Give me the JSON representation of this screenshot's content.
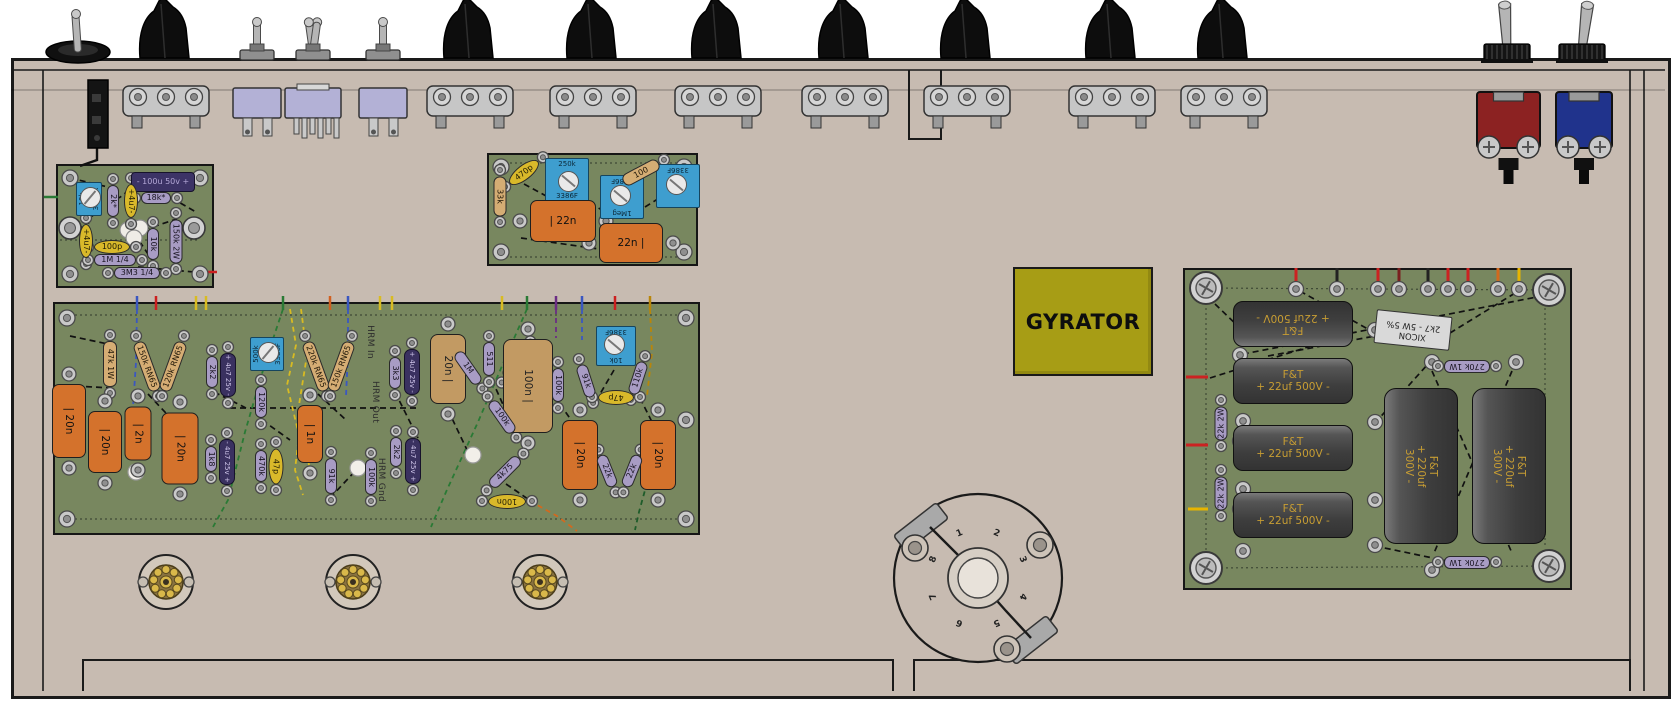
{
  "colors": {
    "chassis": "#c7bbb1",
    "board_green": "#78875f",
    "cap_orange": "#d4722c",
    "cap_tan": "#c29a63",
    "resistor_purple": "#a89cc4",
    "trimmer_blue": "#3e9ecf",
    "gyrator_yellow": "#a79d15",
    "power_cap_gray": "#3e3e3e",
    "power_cap_text": "#c79d33"
  },
  "labels": {
    "gyrator": "GYRATOR"
  },
  "rotary": {
    "pins": [
      "1",
      "2",
      "3",
      "4",
      "5",
      "6",
      "7",
      "8"
    ]
  },
  "tube_sockets": [
    {
      "x": 166,
      "y": 582
    },
    {
      "x": 353,
      "y": 582
    },
    {
      "x": 540,
      "y": 582
    }
  ],
  "top_controls": {
    "power_toggle": {
      "x": 78
    },
    "knobs": [
      {
        "x": 166
      },
      {
        "x": 470
      },
      {
        "x": 593
      },
      {
        "x": 718
      },
      {
        "x": 845
      },
      {
        "x": 967
      },
      {
        "x": 1112
      },
      {
        "x": 1224
      }
    ],
    "small_toggles": [
      {
        "x": 257,
        "double": false
      },
      {
        "x": 313,
        "double": true
      },
      {
        "x": 383,
        "double": false
      }
    ],
    "big_toggles": [
      {
        "x": 1507,
        "tilt": -3
      },
      {
        "x": 1582,
        "tilt": 7
      }
    ],
    "binding_posts": [
      {
        "x": 1477,
        "w": 63,
        "color": "#8c2222"
      },
      {
        "x": 1556,
        "w": 56,
        "color": "#20338c"
      }
    ]
  },
  "boards": [
    {
      "id": "small-preamp-board",
      "x": 56,
      "y": 164,
      "w": 158,
      "h": 124,
      "components": [
        {
          "t": "box",
          "x": 163,
          "y": 182,
          "w": 64,
          "h": 20,
          "r": 0,
          "v": "- 100u 50v +"
        },
        {
          "t": "bt",
          "x": 89,
          "y": 199,
          "w": 34,
          "h": 26,
          "r": -90,
          "v": "10k/3296X"
        },
        {
          "t": "pr",
          "x": 113,
          "y": 201,
          "w": 32,
          "h": 12,
          "r": 90,
          "v": "2k*"
        },
        {
          "t": "yc",
          "x": 131,
          "y": 201,
          "w": 34,
          "h": 14,
          "r": 90,
          "v": "+4u7-"
        },
        {
          "t": "pr",
          "x": 156,
          "y": 198,
          "w": 30,
          "h": 12,
          "r": 0,
          "v": "18k*"
        },
        {
          "t": "yc",
          "x": 86,
          "y": 241,
          "w": 34,
          "h": 14,
          "r": 90,
          "v": "+4u7-"
        },
        {
          "t": "pr",
          "x": 153,
          "y": 244,
          "w": 32,
          "h": 12,
          "r": 90,
          "v": "10k"
        },
        {
          "t": "pr",
          "x": 176,
          "y": 241,
          "w": 44,
          "h": 13,
          "r": 90,
          "v": "150k 2W"
        },
        {
          "t": "yc",
          "x": 112,
          "y": 247,
          "w": 36,
          "h": 14,
          "r": 0,
          "v": "100p"
        },
        {
          "t": "pr",
          "x": 115,
          "y": 260,
          "w": 42,
          "h": 12,
          "r": 0,
          "v": "1M 1/4"
        },
        {
          "t": "pr",
          "x": 137,
          "y": 273,
          "w": 46,
          "h": 12,
          "r": 0,
          "v": "3M3 1/4"
        }
      ]
    },
    {
      "id": "trimmer-board",
      "x": 487,
      "y": 153,
      "w": 211,
      "h": 113,
      "components": [
        {
          "t": "tr",
          "x": 500,
          "y": 196,
          "w": 40,
          "h": 13,
          "r": 90,
          "v": "33k"
        },
        {
          "t": "yc",
          "x": 524,
          "y": 172,
          "w": 36,
          "h": 15,
          "r": -38,
          "v": "470p"
        },
        {
          "t": "bt",
          "x": 567,
          "y": 180,
          "w": 44,
          "h": 44,
          "r": 0,
          "v": "250k/3386F"
        },
        {
          "t": "bt",
          "x": 622,
          "y": 197,
          "w": 44,
          "h": 44,
          "r": 180,
          "v": "1Meg/3386F"
        },
        {
          "t": "bt",
          "x": 678,
          "y": 186,
          "w": 44,
          "h": 44,
          "r": 180,
          "v": "/3386F"
        },
        {
          "t": "tr",
          "x": 641,
          "y": 172,
          "w": 40,
          "h": 13,
          "r": -28,
          "v": "100"
        },
        {
          "t": "or",
          "x": 563,
          "y": 221,
          "w": 66,
          "h": 42,
          "r": 0,
          "v": "| 22n"
        },
        {
          "t": "or",
          "x": 631,
          "y": 243,
          "w": 64,
          "h": 40,
          "r": 0,
          "v": "22n |"
        }
      ]
    },
    {
      "id": "main-board",
      "x": 53,
      "y": 302,
      "w": 647,
      "h": 233,
      "components": [
        {
          "t": "tr",
          "x": 110,
          "y": 364,
          "w": 46,
          "h": 14,
          "r": 90,
          "v": "47k 1W"
        },
        {
          "t": "tr",
          "x": 147,
          "y": 366,
          "w": 52,
          "h": 13,
          "r": 70,
          "v": "150k RN65"
        },
        {
          "t": "tr",
          "x": 173,
          "y": 366,
          "w": 52,
          "h": 13,
          "r": -70,
          "v": "120k RN65"
        },
        {
          "t": "or",
          "x": 69,
          "y": 421,
          "w": 74,
          "h": 34,
          "r": 90,
          "v": "| 20n"
        },
        {
          "t": "or",
          "x": 105,
          "y": 442,
          "w": 62,
          "h": 34,
          "r": 90,
          "v": "| 20n"
        },
        {
          "t": "or",
          "x": 138,
          "y": 433,
          "w": 54,
          "h": 27,
          "r": 90,
          "v": "| 2n"
        },
        {
          "t": "or",
          "x": 180,
          "y": 448,
          "w": 72,
          "h": 37,
          "r": 90,
          "v": "| 20n"
        },
        {
          "t": "pr",
          "x": 212,
          "y": 372,
          "w": 32,
          "h": 12,
          "r": 90,
          "v": "2k2"
        },
        {
          "t": "dk",
          "x": 228,
          "y": 375,
          "w": 44,
          "h": 16,
          "r": 90,
          "v": "+ 4u7 25v -"
        },
        {
          "t": "bt",
          "x": 267,
          "y": 354,
          "w": 34,
          "h": 34,
          "r": -90,
          "v": "500k/3386F"
        },
        {
          "t": "pr",
          "x": 261,
          "y": 402,
          "w": 32,
          "h": 12,
          "r": 90,
          "v": "120k"
        },
        {
          "t": "pr",
          "x": 211,
          "y": 459,
          "w": 26,
          "h": 12,
          "r": 90,
          "v": "1k8"
        },
        {
          "t": "dk",
          "x": 227,
          "y": 462,
          "w": 46,
          "h": 16,
          "r": 90,
          "v": "- 4u7 25v +"
        },
        {
          "t": "pr",
          "x": 261,
          "y": 466,
          "w": 32,
          "h": 12,
          "r": 90,
          "v": "470k"
        },
        {
          "t": "yc",
          "x": 276,
          "y": 466,
          "w": 36,
          "h": 15,
          "r": 90,
          "v": "47p"
        },
        {
          "t": "tr",
          "x": 316,
          "y": 366,
          "w": 52,
          "h": 13,
          "r": 70,
          "v": "220k RN65"
        },
        {
          "t": "tr",
          "x": 341,
          "y": 366,
          "w": 52,
          "h": 13,
          "r": -70,
          "v": "150k RN65"
        },
        {
          "t": "or",
          "x": 310,
          "y": 434,
          "w": 58,
          "h": 26,
          "r": 90,
          "v": "| 1n"
        },
        {
          "t": "pr",
          "x": 331,
          "y": 476,
          "w": 36,
          "h": 12,
          "r": 90,
          "v": "91k"
        },
        {
          "t": "pr",
          "x": 371,
          "y": 477,
          "w": 36,
          "h": 12,
          "r": 90,
          "v": "100k"
        },
        {
          "t": "tx",
          "x": 370,
          "y": 342,
          "w": 46,
          "h": 10,
          "r": 90,
          "v": "HRM In"
        },
        {
          "t": "tx",
          "x": 375,
          "y": 402,
          "w": 50,
          "h": 10,
          "r": 90,
          "v": "HRM Out"
        },
        {
          "t": "tx",
          "x": 381,
          "y": 480,
          "w": 52,
          "h": 10,
          "r": 90,
          "v": "HRM Gnd"
        },
        {
          "t": "pr",
          "x": 395,
          "y": 373,
          "w": 32,
          "h": 12,
          "r": 90,
          "v": "3k3"
        },
        {
          "t": "dk",
          "x": 412,
          "y": 372,
          "w": 46,
          "h": 16,
          "r": 90,
          "v": "+ 4u7 25v -"
        },
        {
          "t": "pr",
          "x": 396,
          "y": 452,
          "w": 30,
          "h": 12,
          "r": 90,
          "v": "2k2"
        },
        {
          "t": "dk",
          "x": 413,
          "y": 461,
          "w": 46,
          "h": 16,
          "r": 90,
          "v": "- 4u7 25v +"
        },
        {
          "t": "tan",
          "x": 448,
          "y": 369,
          "w": 70,
          "h": 36,
          "r": 90,
          "v": "20n |"
        },
        {
          "t": "pr",
          "x": 468,
          "y": 368,
          "w": 38,
          "h": 12,
          "r": 55,
          "v": "1M"
        },
        {
          "t": "pr",
          "x": 516,
          "y": 362,
          "w": 38,
          "h": 12,
          "r": -55,
          "v": "1M"
        },
        {
          "t": "pr",
          "x": 489,
          "y": 359,
          "w": 34,
          "h": 12,
          "r": 90,
          "v": "511"
        },
        {
          "t": "tan",
          "x": 528,
          "y": 386,
          "w": 94,
          "h": 50,
          "r": 90,
          "v": "100n |"
        },
        {
          "t": "pr",
          "x": 502,
          "y": 417,
          "w": 38,
          "h": 12,
          "r": 55,
          "v": "100k"
        },
        {
          "t": "pr",
          "x": 558,
          "y": 385,
          "w": 34,
          "h": 12,
          "r": 90,
          "v": "100k"
        },
        {
          "t": "bt",
          "x": 616,
          "y": 346,
          "w": 40,
          "h": 40,
          "r": 180,
          "v": "10k/3386F"
        },
        {
          "t": "pr",
          "x": 586,
          "y": 381,
          "w": 34,
          "h": 12,
          "r": 72,
          "v": "91k"
        },
        {
          "t": "pr",
          "x": 638,
          "y": 378,
          "w": 34,
          "h": 12,
          "r": -72,
          "v": "110k"
        },
        {
          "t": "yc",
          "x": 616,
          "y": 397,
          "w": 36,
          "h": 15,
          "r": 180,
          "v": "47p"
        },
        {
          "t": "or",
          "x": 580,
          "y": 455,
          "w": 70,
          "h": 36,
          "r": 90,
          "v": "| 20n"
        },
        {
          "t": "or",
          "x": 658,
          "y": 455,
          "w": 70,
          "h": 36,
          "r": 90,
          "v": "| 20n"
        },
        {
          "t": "pr",
          "x": 607,
          "y": 471,
          "w": 34,
          "h": 12,
          "r": 68,
          "v": "22k"
        },
        {
          "t": "pr",
          "x": 632,
          "y": 471,
          "w": 34,
          "h": 12,
          "r": -68,
          "v": "22k"
        },
        {
          "t": "pr",
          "x": 505,
          "y": 472,
          "w": 40,
          "h": 12,
          "r": -45,
          "v": "4k75"
        },
        {
          "t": "yc",
          "x": 507,
          "y": 501,
          "w": 38,
          "h": 15,
          "r": 180,
          "v": "100n"
        }
      ]
    },
    {
      "id": "power-supply-board",
      "x": 1183,
      "y": 268,
      "w": 389,
      "h": 322,
      "components": [
        {
          "t": "pc",
          "x": 1293,
          "y": 324,
          "w": 120,
          "h": 46,
          "r": 180,
          "v": "F&T\n+ 22uf 500V -"
        },
        {
          "t": "pc",
          "x": 1293,
          "y": 381,
          "w": 120,
          "h": 46,
          "r": 0,
          "v": "F&T\n+ 22uf 500V -"
        },
        {
          "t": "pc",
          "x": 1293,
          "y": 448,
          "w": 120,
          "h": 46,
          "r": 0,
          "v": "F&T\n+ 22uf 500V -"
        },
        {
          "t": "pc",
          "x": 1293,
          "y": 515,
          "w": 120,
          "h": 46,
          "r": 0,
          "v": "F&T\n+ 22uf 500V -"
        },
        {
          "t": "pr",
          "x": 1221,
          "y": 423,
          "w": 34,
          "h": 13,
          "r": -90,
          "v": "22k 2W"
        },
        {
          "t": "pr",
          "x": 1221,
          "y": 493,
          "w": 34,
          "h": 13,
          "r": -90,
          "v": "22k 2W"
        },
        {
          "t": "wr",
          "x": 1413,
          "y": 330,
          "w": 76,
          "h": 34,
          "r": 186,
          "v": "XICON\n2k7 - 5W 5%"
        },
        {
          "t": "pr",
          "x": 1467,
          "y": 366,
          "w": 46,
          "h": 13,
          "r": 180,
          "v": "270k 1W"
        },
        {
          "t": "pr",
          "x": 1467,
          "y": 562,
          "w": 46,
          "h": 13,
          "r": 180,
          "v": "270k 1W"
        },
        {
          "t": "pc2",
          "x": 1421,
          "y": 466,
          "w": 74,
          "h": 156,
          "r": 0,
          "trot": 90,
          "v": "F&T\n+ 220uf 300V -"
        },
        {
          "t": "pc2",
          "x": 1509,
          "y": 466,
          "w": 74,
          "h": 156,
          "r": 0,
          "trot": 90,
          "v": "F&T\n+ 220uf 300V -"
        }
      ]
    }
  ]
}
